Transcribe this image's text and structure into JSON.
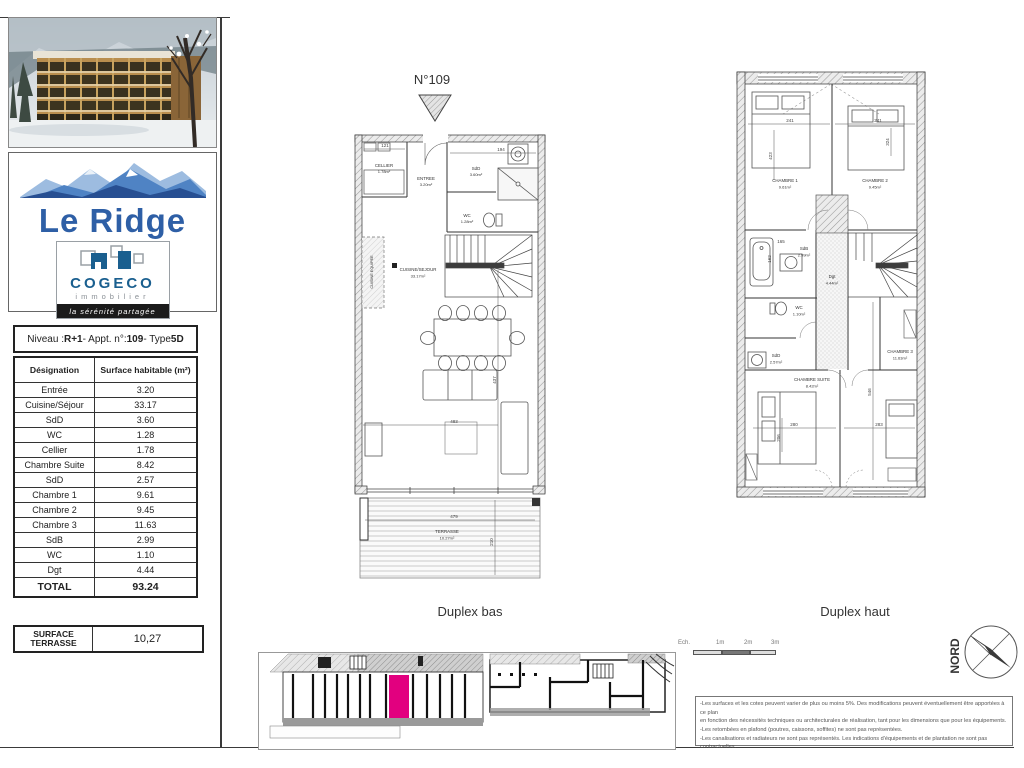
{
  "sheet": {
    "project": "Le Ridge",
    "agency": {
      "name": "COGECO",
      "field": "immobilier",
      "tagline": "la sérénité partagée"
    }
  },
  "info_table": {
    "title_parts": [
      "Niveau : ",
      "R+1",
      " - Appt. n°: ",
      "109",
      " - Type ",
      "5D"
    ],
    "headers": [
      "Désignation",
      "Surface habitable (m²)"
    ],
    "rows": [
      [
        "Entrée",
        "3.20"
      ],
      [
        "Cuisine/Séjour",
        "33.17"
      ],
      [
        "SdD",
        "3.60"
      ],
      [
        "WC",
        "1.28"
      ],
      [
        "Cellier",
        "1.78"
      ],
      [
        "Chambre Suite",
        "8.42"
      ],
      [
        "SdD",
        "2.57"
      ],
      [
        "Chambre 1",
        "9.61"
      ],
      [
        "Chambre 2",
        "9.45"
      ],
      [
        "Chambre 3",
        "11.63"
      ],
      [
        "SdB",
        "2.99"
      ],
      [
        "WC",
        "1.10"
      ],
      [
        "Dgt",
        "4.44"
      ]
    ],
    "total": [
      "TOTAL",
      "93.24"
    ]
  },
  "terrace_table": {
    "label_line1": "SURFACE",
    "label_line2": "TERRASSE",
    "value": "10,27"
  },
  "plans": {
    "unit_marker": "N°109",
    "duplex_bas": {
      "caption": "Duplex bas",
      "rooms": {
        "cellier": {
          "name": "CELLIER",
          "area": "1.78m²"
        },
        "entree": {
          "name": "ENTREE",
          "area": "3.20m²"
        },
        "sdd": {
          "name": "SdD",
          "area": "3.60m²"
        },
        "wc": {
          "name": "WC",
          "area": "1.28m²"
        },
        "cuisine_sejour": {
          "name": "CUISINE/SEJOUR",
          "area": "33.17m²"
        },
        "cuisine_equipee": {
          "name": "CUISINE EQUIPEE"
        },
        "terrasse": {
          "name": "TERRASSE",
          "area": "10.27m²"
        }
      },
      "dims": [
        "121",
        "194",
        "483",
        "437",
        "479",
        "210"
      ]
    },
    "duplex_haut": {
      "caption": "Duplex haut",
      "rooms": {
        "chambre1": {
          "name": "CHAMBRE 1",
          "area": "9.61m²"
        },
        "chambre2": {
          "name": "CHAMBRE 2",
          "area": "9.45m²"
        },
        "sdb": {
          "name": "SdB",
          "area": "2.99m²"
        },
        "dgt": {
          "name": "Dgt",
          "area": "4.44m²"
        },
        "wc": {
          "name": "WC",
          "area": "1.10m²"
        },
        "sdd": {
          "name": "SdD",
          "area": "2.57m²"
        },
        "chambre_suite": {
          "name": "CHAMBRE SUITE",
          "area": "8.42m²"
        },
        "chambre3": {
          "name": "CHAMBRE 3",
          "area": "11.63m²"
        }
      },
      "dims": [
        "241",
        "241",
        "423",
        "324",
        "165",
        "162",
        "280",
        "283",
        "546",
        "206"
      ]
    }
  },
  "scale_bar": {
    "labels": [
      "Ech.",
      "1m",
      "2m",
      "3m"
    ]
  },
  "compass": {
    "label": "NORD"
  },
  "disclaimer": {
    "lines": [
      "-Les surfaces et les cotes peuvent varier de plus ou moins 5%. Des modifications peuvent éventuellement être apportées à ce plan",
      "en fonction des nécessités techniques ou architecturales de réalisation, tant pour les dimensions que pour les équipements.",
      "-Les retombées en plafond (poutres, caissons, soffites) ne sont pas représentées.",
      "-Les canalisations et radiateurs ne sont pas représentés. Les indications d'équipements et de plantation ne sont pas contractuelles."
    ]
  },
  "colors": {
    "highlight_pink": "#e2007f",
    "brand_blue": "#2e5fa6",
    "cogeco_blue": "#1a5f8f"
  }
}
